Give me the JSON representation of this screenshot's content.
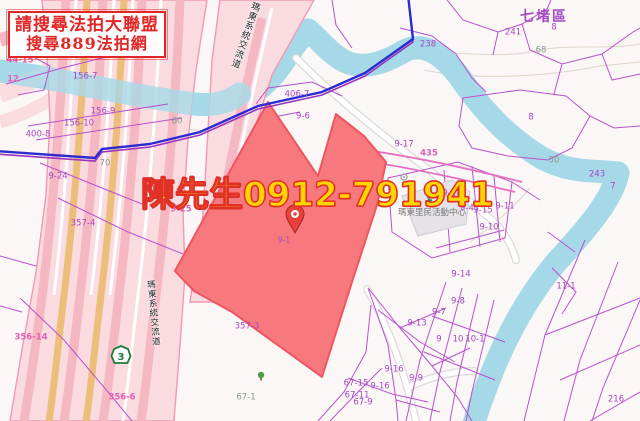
{
  "promo_box": {
    "line1": "請搜尋法拍大聯盟",
    "line2": "搜尋889法拍網"
  },
  "watermark": "陳先生0912-791941",
  "map": {
    "district_label": "七堵區",
    "interchange_label": "瑪東系統交流道",
    "activity_center_label": "瑪東里民活動中心",
    "highway_shield_number": "3",
    "pin_parcel_label": "9-1",
    "parcel_labels": [
      {
        "text": "44-15",
        "x": 20,
        "y": 61,
        "cls": "pink"
      },
      {
        "text": "12",
        "x": 13,
        "y": 80,
        "cls": "pink"
      },
      {
        "text": "156-7",
        "x": 85,
        "y": 77,
        "cls": "purple"
      },
      {
        "text": "156-9",
        "x": 103,
        "y": 112,
        "cls": "purple"
      },
      {
        "text": "156-10",
        "x": 79,
        "y": 124,
        "cls": "purple"
      },
      {
        "text": "400-8",
        "x": 38,
        "y": 135,
        "cls": "purple"
      },
      {
        "text": "70",
        "x": 105,
        "y": 164,
        "cls": "gray"
      },
      {
        "text": "60",
        "x": 177,
        "y": 122,
        "cls": "gray"
      },
      {
        "text": "9-24",
        "x": 58,
        "y": 177,
        "cls": "purple"
      },
      {
        "text": "9-25",
        "x": 181,
        "y": 210,
        "cls": "pink"
      },
      {
        "text": "357-4",
        "x": 83,
        "y": 224,
        "cls": "purple"
      },
      {
        "text": "356-14",
        "x": 31,
        "y": 338,
        "cls": "pink"
      },
      {
        "text": "356-6",
        "x": 122,
        "y": 398,
        "cls": "pink"
      },
      {
        "text": "357-3",
        "x": 247,
        "y": 327,
        "cls": "purple"
      },
      {
        "text": "67-1",
        "x": 246,
        "y": 398,
        "cls": "gray"
      },
      {
        "text": "406-7",
        "x": 297,
        "y": 95,
        "cls": "purple"
      },
      {
        "text": "9-6",
        "x": 303,
        "y": 117,
        "cls": "purple"
      },
      {
        "text": "9-17",
        "x": 404,
        "y": 145,
        "cls": "purple"
      },
      {
        "text": "435",
        "x": 429,
        "y": 154,
        "cls": "pink"
      },
      {
        "text": "238",
        "x": 428,
        "y": 45,
        "cls": "purple"
      },
      {
        "text": "241",
        "x": 513,
        "y": 33,
        "cls": "purple"
      },
      {
        "text": "8",
        "x": 554,
        "y": 28,
        "cls": "purple"
      },
      {
        "text": "68",
        "x": 541,
        "y": 51,
        "cls": "gray"
      },
      {
        "text": "8",
        "x": 531,
        "y": 118,
        "cls": "purple"
      },
      {
        "text": "50",
        "x": 554,
        "y": 161,
        "cls": "gray"
      },
      {
        "text": "243",
        "x": 597,
        "y": 175,
        "cls": "purple"
      },
      {
        "text": "7",
        "x": 613,
        "y": 187,
        "cls": "purple"
      },
      {
        "text": "11-1",
        "x": 566,
        "y": 287,
        "cls": "purple"
      },
      {
        "text": "216",
        "x": 616,
        "y": 400,
        "cls": "purple"
      },
      {
        "text": "9-14",
        "x": 461,
        "y": 275,
        "cls": "purple"
      },
      {
        "text": "9-8",
        "x": 458,
        "y": 302,
        "cls": "purple"
      },
      {
        "text": "9-7",
        "x": 439,
        "y": 313,
        "cls": "purple"
      },
      {
        "text": "9-13",
        "x": 417,
        "y": 324,
        "cls": "purple"
      },
      {
        "text": "9",
        "x": 439,
        "y": 340,
        "cls": "purple"
      },
      {
        "text": "10",
        "x": 458,
        "y": 340,
        "cls": "purple"
      },
      {
        "text": "10-1",
        "x": 475,
        "y": 340,
        "cls": "purple"
      },
      {
        "text": "9-16",
        "x": 394,
        "y": 370,
        "cls": "purple"
      },
      {
        "text": "9-9",
        "x": 416,
        "y": 379,
        "cls": "purple"
      },
      {
        "text": "67-15",
        "x": 356,
        "y": 384,
        "cls": "purple"
      },
      {
        "text": "9-16",
        "x": 380,
        "y": 387,
        "cls": "purple"
      },
      {
        "text": "67-11",
        "x": 357,
        "y": 396,
        "cls": "purple"
      },
      {
        "text": "67-9",
        "x": 363,
        "y": 403,
        "cls": "purple"
      },
      {
        "text": "9-18",
        "x": 452,
        "y": 194,
        "cls": "purple"
      },
      {
        "text": "9-4",
        "x": 467,
        "y": 209,
        "cls": "purple"
      },
      {
        "text": "9-15",
        "x": 483,
        "y": 211,
        "cls": "purple"
      },
      {
        "text": "9-11",
        "x": 505,
        "y": 207,
        "cls": "purple"
      },
      {
        "text": "9-10",
        "x": 489,
        "y": 228,
        "cls": "purple"
      }
    ]
  },
  "colors": {
    "bg": "#fbf7f6",
    "river": "#a5d9e8",
    "hwy-base": "#fadbe0",
    "hwy-stripe": "#f5b7c2",
    "hwy-orange": "#edbe7a",
    "hwy-edge": "#ef9ab4",
    "road-casing": "#ded9d9",
    "cadastral": "#b852cc",
    "cadastral-pink": "#e46fc2",
    "parcel-fill": "#f8797d",
    "parcel-edge": "#ee5560",
    "boundary-blue": "#2b2bd2",
    "boundary-purple": "#9a35bd",
    "label-purple": "#a448c4",
    "label-pink": "#e45fb4",
    "label-gray": "#8a9a8e",
    "promo-red": "#e02626",
    "watermark-yellow": "#ffd400",
    "watermark-red": "#e03028",
    "contour": "#d9cfc2",
    "building-fill": "#e6e3e8",
    "building-edge": "#cfcbd6",
    "pin-red": "#e8403a",
    "shield-green": "#1d7a3c",
    "tree-green": "#4a9d4a",
    "runner-green": "#3a7d44",
    "poi-gray": "#9a96a2"
  }
}
